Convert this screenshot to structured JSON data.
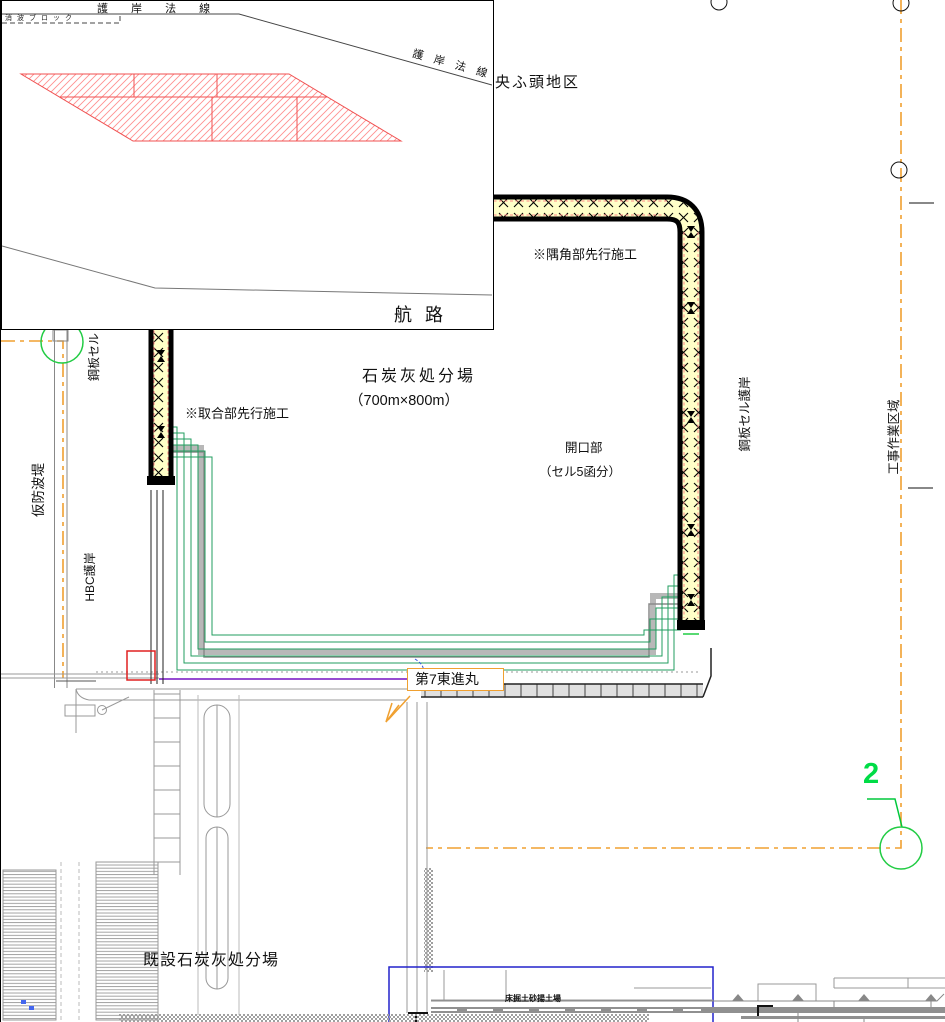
{
  "inset": {
    "revetment_line_label_top": "護 岸 法 線",
    "revetment_line_label_diagonal": "護 岸 法 線",
    "wave_block_label": "消波ブロック",
    "channel_label": "航  路"
  },
  "main": {
    "pier_district_label": "央ふ頭地区",
    "corner_precede_note": "※隅角部先行施工",
    "joint_precede_note": "※取合部先行施工",
    "disposal_site_name": "石炭灰処分場",
    "disposal_site_size": "（700m×800m）",
    "opening_label": "開口部",
    "opening_detail": "（セル5函分）",
    "steel_cell_label": "鋼板セル",
    "steel_cell_quay_label": "鋼板セル護岸",
    "work_area_label": "工事作業区域",
    "temporary_breakwater_label": "仮防波堤",
    "hbc_quay_label": "HBC護岸",
    "ship_name": "第7東進丸",
    "existing_disposal_site": "既設石炭灰処分場",
    "dredged_soil_yard_label": "床掘土砂揚土場",
    "section_marker": "2"
  },
  "colors": {
    "wall_fill": "#FFFFC8",
    "wall_border": "#000000",
    "wall_inner_dash": "#FF8888",
    "boundary_orange": "#F0A030",
    "contour_green": "#219E5F",
    "marker_green": "#00DC46",
    "hatch_red": "#FF8080",
    "access_purple": "#8833CC",
    "yard_blue": "#2222CC",
    "linework_gray": "#909090"
  }
}
